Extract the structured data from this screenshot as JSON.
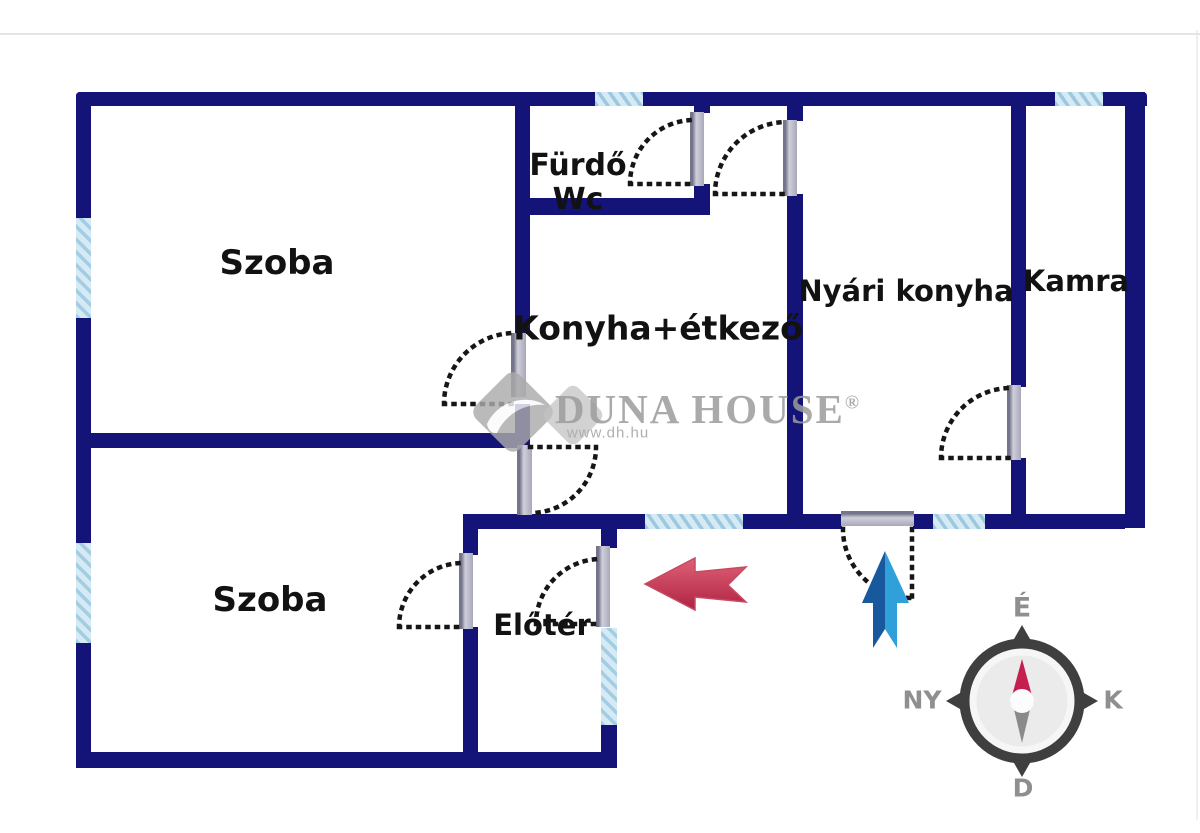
{
  "rooms": [
    {
      "id": "szoba-1",
      "label": "Szoba"
    },
    {
      "id": "furdo-wc",
      "label": "Fürdő",
      "label_line2": "Wc"
    },
    {
      "id": "konyha-etkezo",
      "label": "Konyha+étkező"
    },
    {
      "id": "nyari-konyha",
      "label": "Nyári konyha"
    },
    {
      "id": "kamra",
      "label": "Kamra"
    },
    {
      "id": "szoba-2",
      "label": "Szoba"
    },
    {
      "id": "eloter",
      "label": "Előtér"
    }
  ],
  "compass": {
    "north_label": "É",
    "south_label": "D",
    "west_label": "NY",
    "east_label": "K"
  },
  "watermark": {
    "brand": "DUNA HOUSE",
    "registered_mark": "®",
    "website": "www.dh.hu"
  },
  "colors": {
    "wall": "#131378",
    "window_fill": "#d6eaf5",
    "window_stripe": "#a3cde2",
    "door_arc": "#161616",
    "door_jamb": "#b5b5c4",
    "red_arrow": "#cf3355",
    "blue_arrow_dark": "#17599c",
    "blue_arrow_light": "#2fa0d9",
    "compass_ring": "#3f3f3f",
    "compass_needle_north": "#c41f4e",
    "compass_needle_south": "#8a8a8a",
    "watermark_gray": "#9c9c9c"
  }
}
